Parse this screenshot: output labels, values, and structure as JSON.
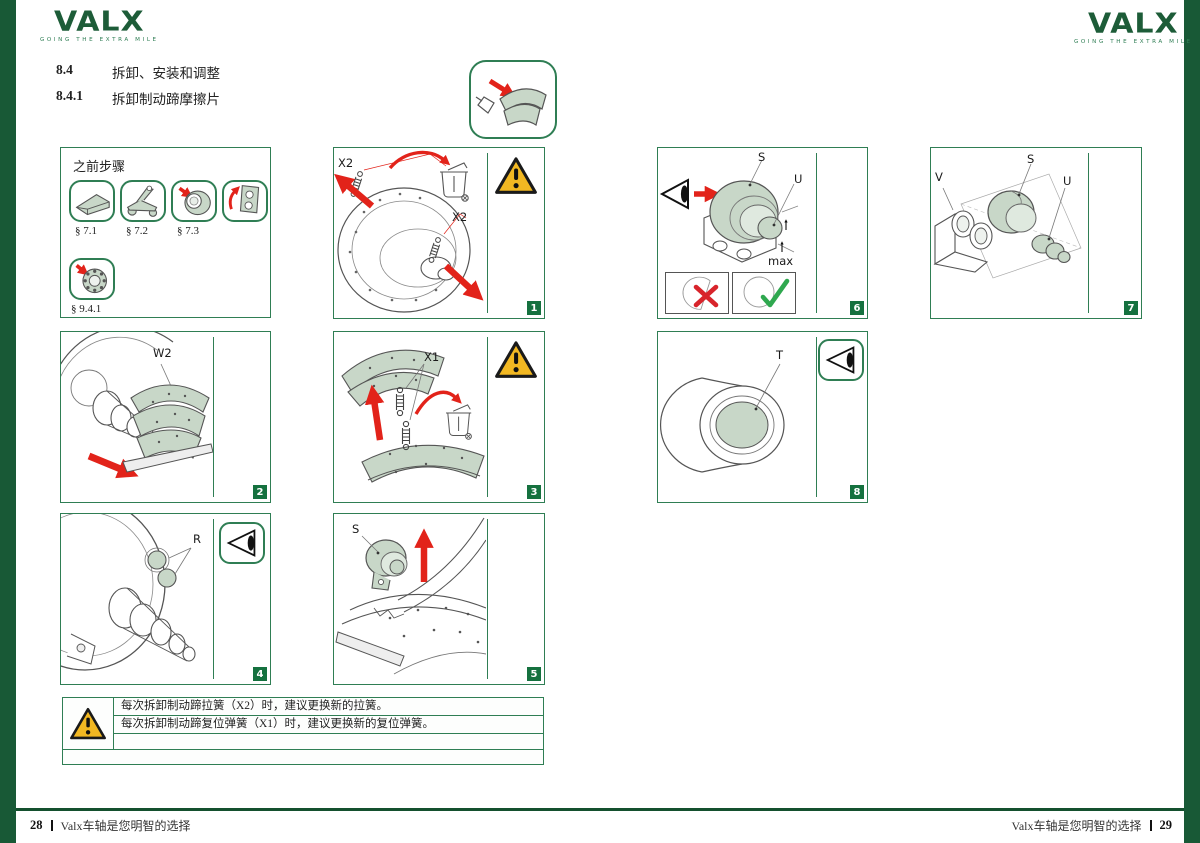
{
  "brand": {
    "name": "VALX",
    "tagline": "GOING THE EXTRA MILE"
  },
  "heading": {
    "section_no": "8.4",
    "section_title": "拆卸、安装和调整",
    "sub_no": "8.4.1",
    "sub_title": "拆卸制动蹄摩擦片"
  },
  "prev_steps": {
    "title": "之前步骤",
    "refs": {
      "r1": "§ 7.1",
      "r2": "§ 7.2",
      "r3": "§ 7.3",
      "r4": "§ 9.4.1"
    }
  },
  "panels": {
    "p1": {
      "num": "1",
      "label_a": "X2",
      "label_b": "X2"
    },
    "p2": {
      "num": "2",
      "label_a": "W2"
    },
    "p3": {
      "num": "3",
      "label_a": "X1"
    },
    "p4": {
      "num": "4",
      "label_a": "R"
    },
    "p5": {
      "num": "5",
      "label_a": "S"
    },
    "p6": {
      "num": "6",
      "label_s": "S",
      "label_u": "U",
      "label_max": "max"
    },
    "p7": {
      "num": "7",
      "label_v": "V",
      "label_s": "S",
      "label_u": "U"
    },
    "p8": {
      "num": "8",
      "label_t": "T"
    }
  },
  "warning_box": {
    "line1": "每次拆卸制动蹄拉簧（X2）时，建议更换新的拉簧。",
    "line2": "每次拆卸制动蹄复位弹簧（X1）时，建议更换新的复位弹簧。"
  },
  "footer": {
    "page_left": "28",
    "slogan_left": "Valx车轴是您明智的选择",
    "slogan_right": "Valx车轴是您明智的选择",
    "page_right": "29"
  },
  "colors": {
    "brand_green": "#1d5c38",
    "panel_green": "#2f7e54",
    "badge_green": "#15713f",
    "warning_yellow": "#F2B822",
    "alert_red": "#E2231A",
    "part_fill_green": "#c8d7c8"
  }
}
